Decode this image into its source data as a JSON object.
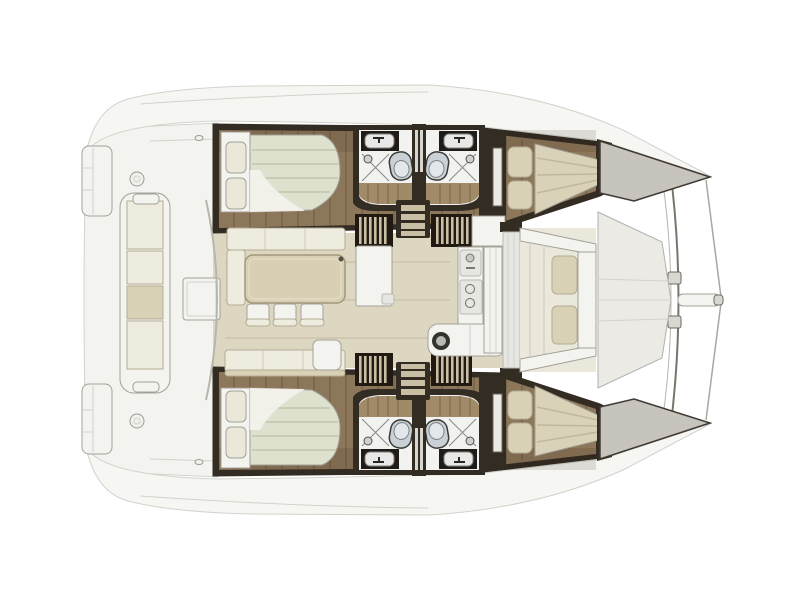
{
  "page": {
    "background": "#ffffff",
    "description": "Catamaran yacht interior layout plan, top view, bow to the right, symmetrical twin hulls"
  },
  "colors": {
    "bg": "#ffffff",
    "deck": "#f6f6f3",
    "deckLine": "#d2d2cd",
    "cockpitFloor": "#f3f3f0",
    "hullDark": "#332c23",
    "wood": "#8d775a",
    "woodLight": "#a08a68",
    "mattress": "#dde1cd",
    "mattressStripe": "#c2c8ae",
    "fwdMattress": "#d9d2b8",
    "fwdStripe": "#c0b89c",
    "pillow": "#ebe7d9",
    "furnWhite": "#f3f3ef",
    "furnStroke": "#a3a097",
    "headsWhite": "#f2f2f0",
    "counterDark": "#1f1c18",
    "toilet": "#c9d0d6",
    "toiletStroke": "#3a3a36",
    "stairDark": "#201a12",
    "stairLight": "#c9bfa4",
    "salonFloor": "#ddd6c0",
    "cushion": "#eeebdf",
    "cushionStroke": "#b4ad94",
    "cushionTan": "#d8d1b6",
    "table": "#d8cfb4",
    "tableStroke": "#a1977b",
    "bowDeck": "#c7c4be",
    "bowStroke": "#403a32",
    "foredeck": "#eceae5"
  },
  "regions": {
    "boat": "Catamaran layout plan, top view",
    "port_hull": "Port hull: aft double cabin, two back-to-back bathrooms with sinks, toilets and showers, forward double cabin",
    "starboard_hull": "Starboard hull: aft double cabin, two back-to-back bathrooms with sinks, toilets and showers, forward double cabin",
    "salon": "Bridgedeck salon with dinette table, three chairs, settees and galley",
    "galley": "Galley counters with sink, stove and corner unit",
    "aft_cockpit": "Aft cockpit with bench seat and table",
    "forward_cockpit": "Forward cockpit with bench seats",
    "foredeck": "Foredeck between hulls",
    "bow": "Bow with crossbeam, bowsprit and bridle lines",
    "transom": "Transom swim platforms"
  },
  "fixtures": {
    "double_beds": 4,
    "bathrooms": 4,
    "toilets": 4,
    "sinks": 4,
    "showers": 4,
    "dining_chairs": 3,
    "companionway_stairs": 4
  }
}
